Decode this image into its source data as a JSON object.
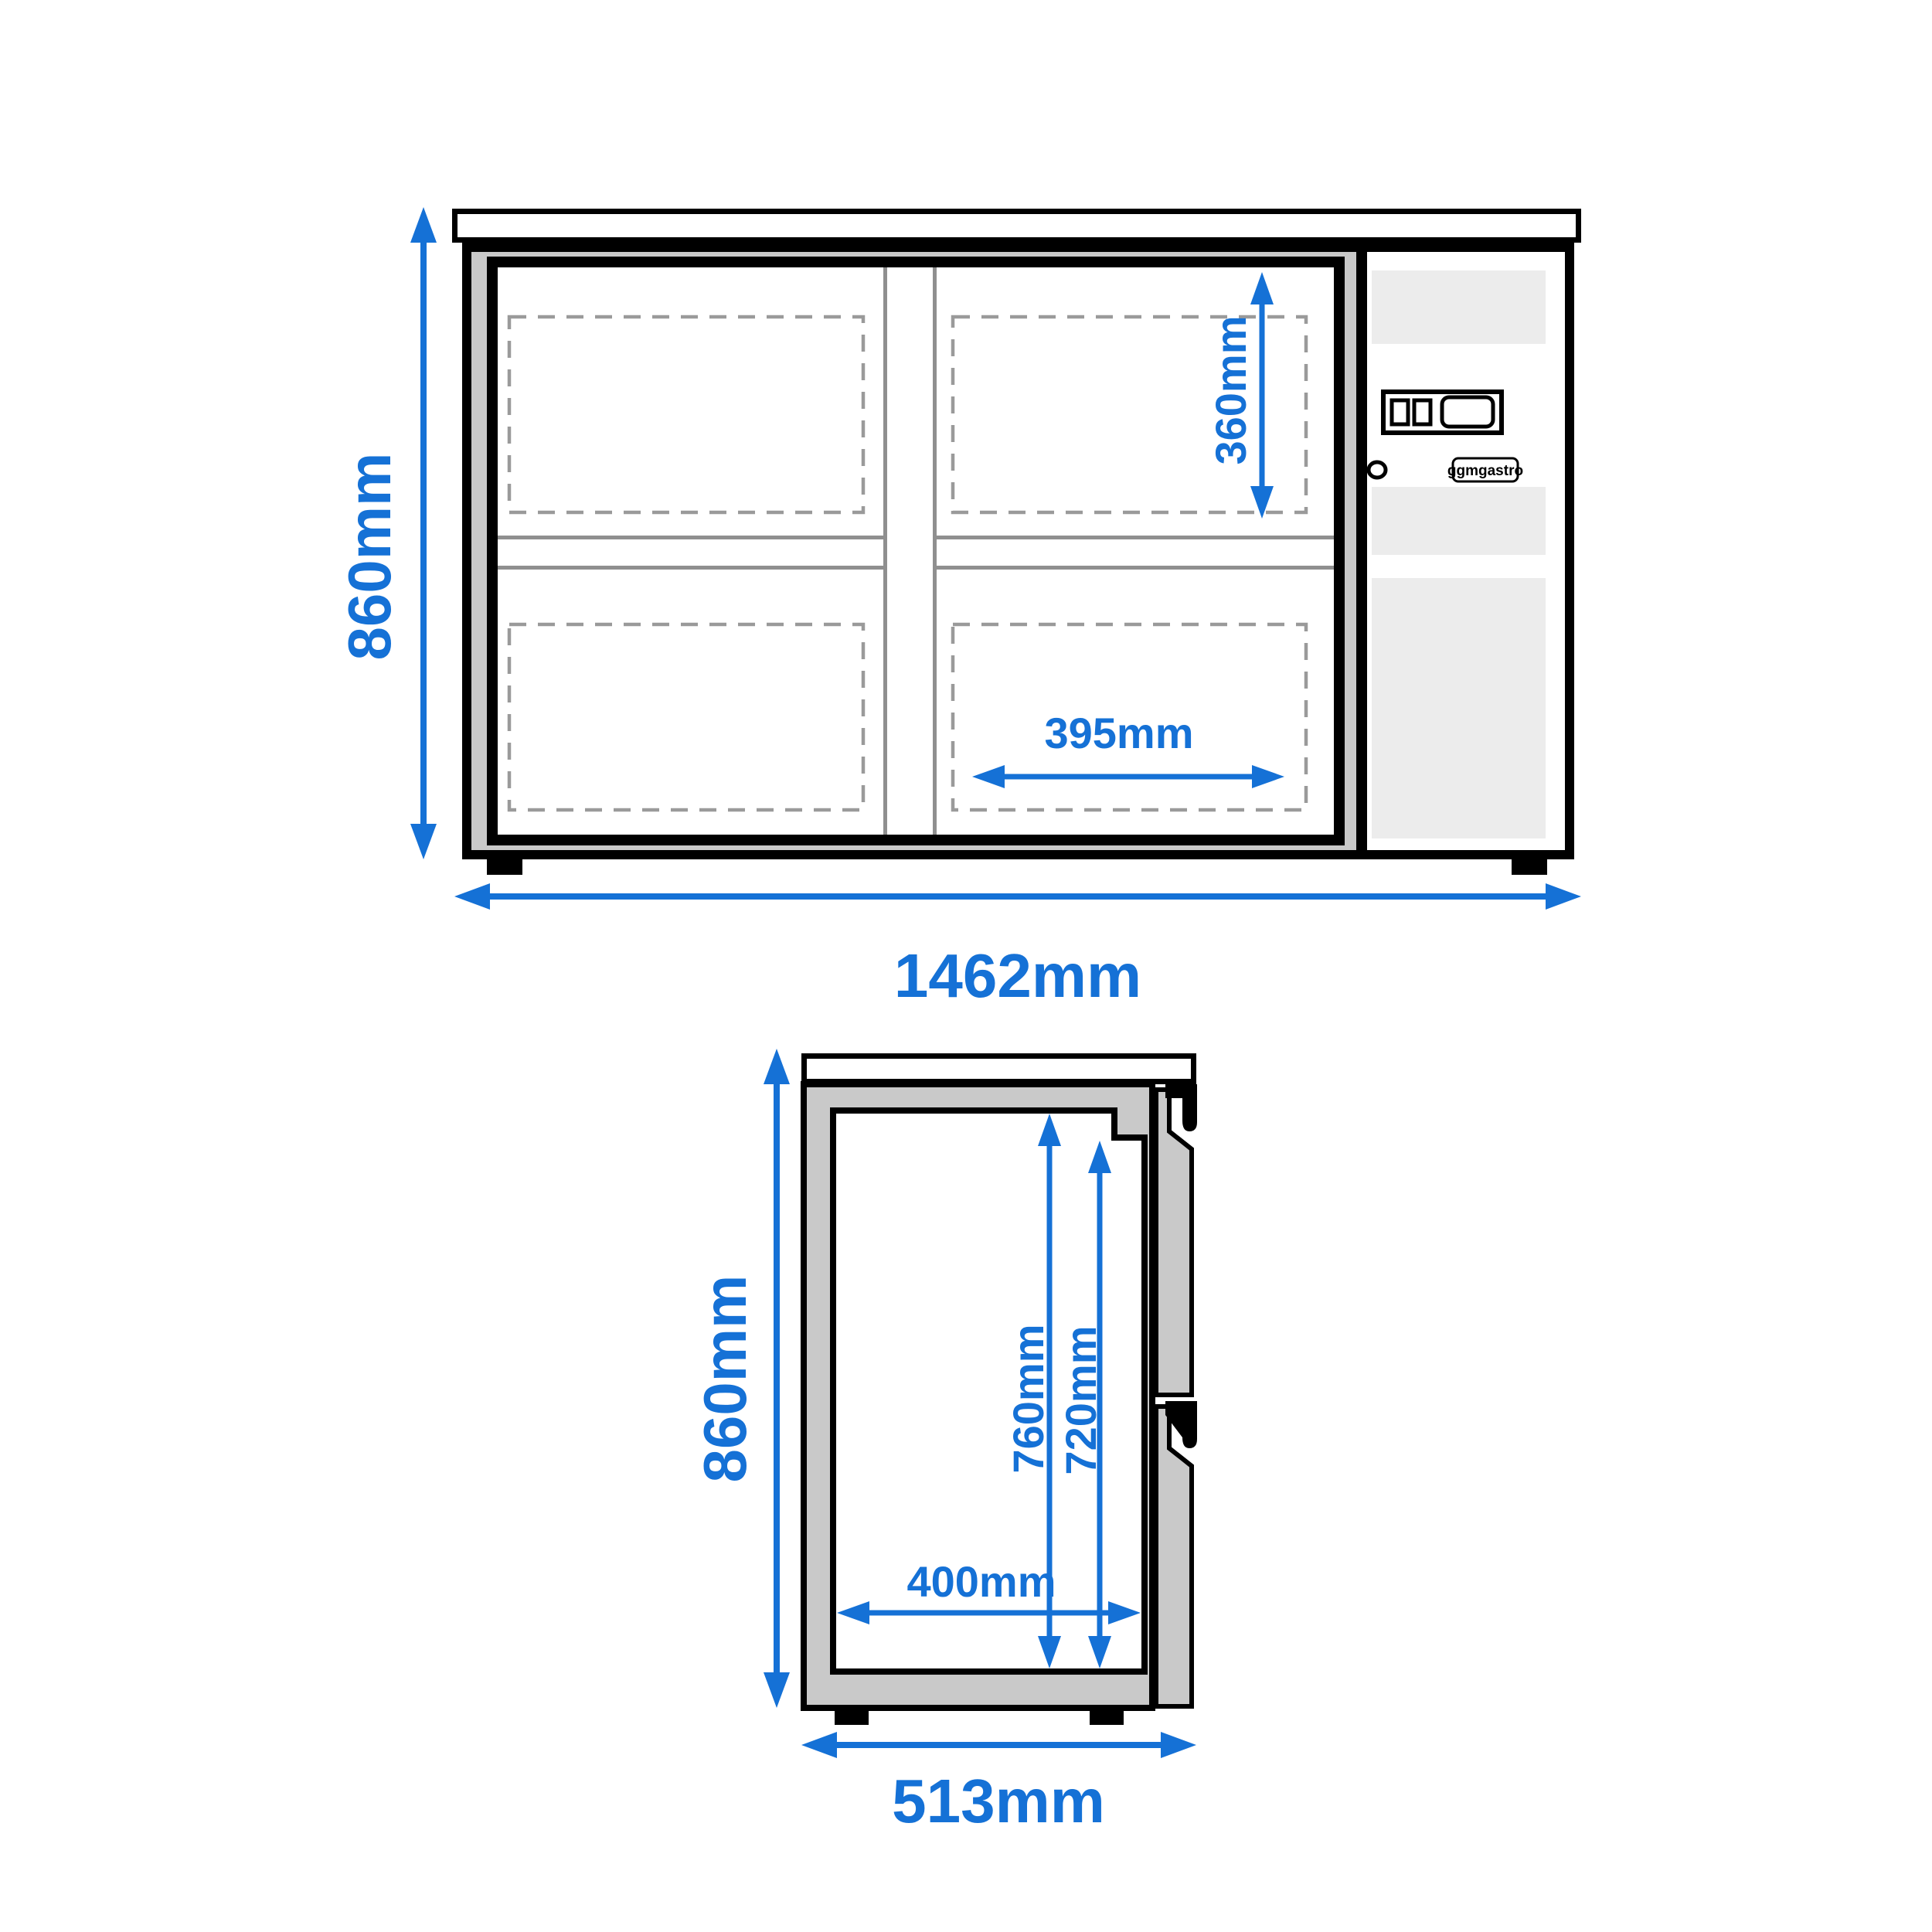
{
  "drawing": {
    "brand_badge": "ggmgastro",
    "front_view": {
      "overall_height": "860mm",
      "overall_width": "1462mm",
      "shelf_inner_height": "360mm",
      "shelf_inner_width": "395mm"
    },
    "side_view": {
      "overall_height": "860mm",
      "overall_depth": "513mm",
      "interior_height_rear": "760mm",
      "interior_height_front": "720mm",
      "interior_depth": "400mm"
    },
    "colors": {
      "dimension_blue": "#1571d6",
      "frame_gray": "#c9c9c9",
      "panel_light_gray": "#ececec",
      "detail_gray": "#8f8f8f",
      "outline_black": "#000000"
    }
  }
}
